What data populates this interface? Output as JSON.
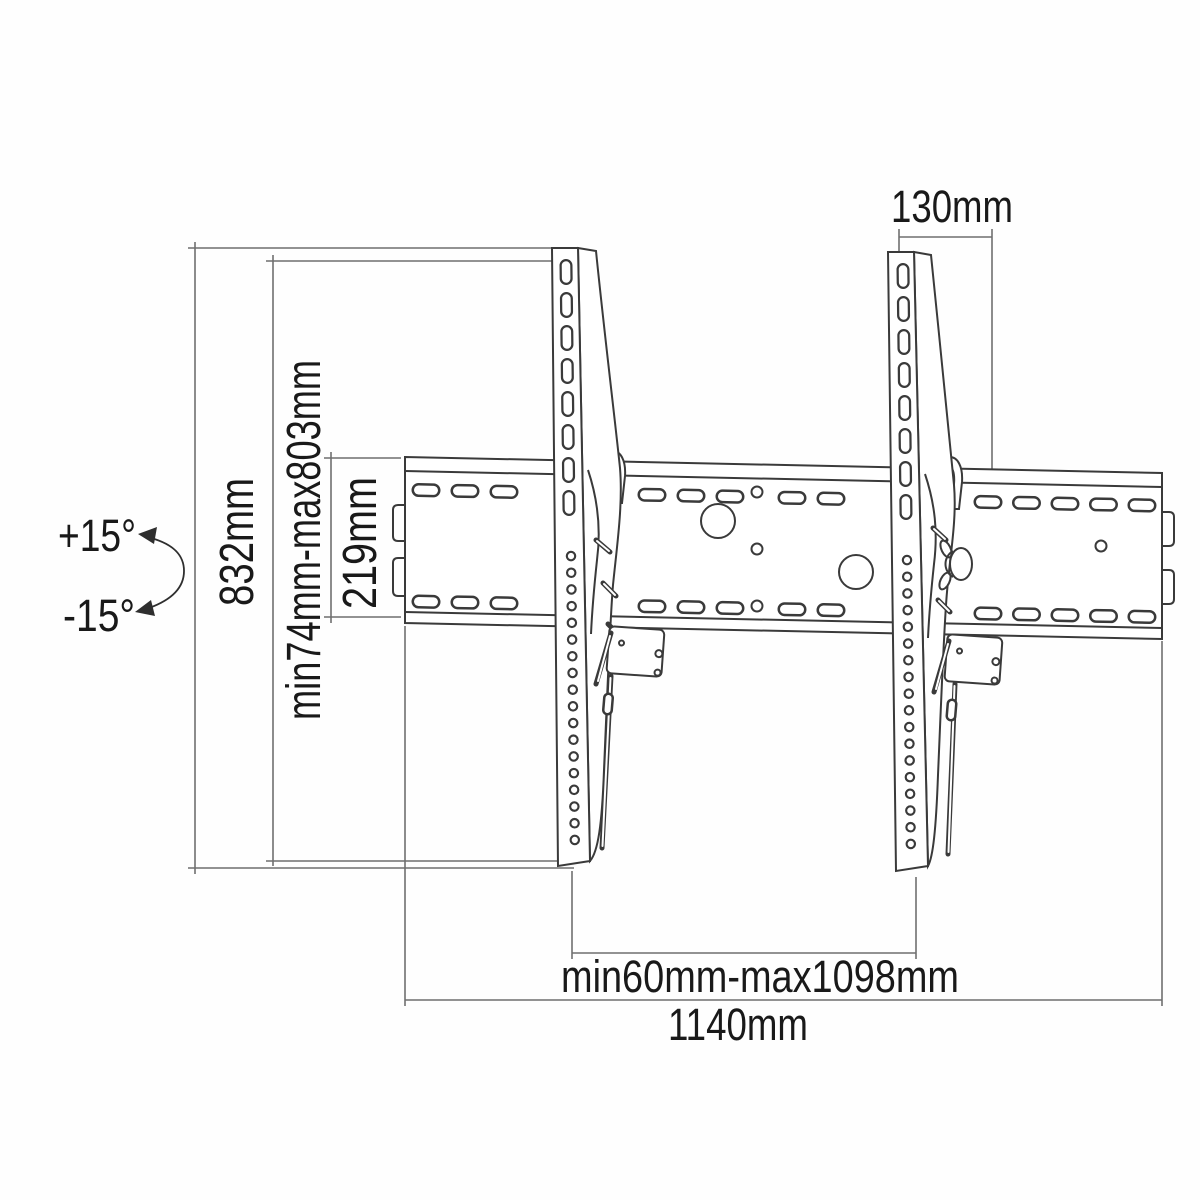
{
  "diagram": {
    "type": "technical-drawing",
    "subject": "Tilting TV wall-mount bracket dimensional diagram",
    "labels": {
      "bracket_top_offset": "130mm",
      "overall_height": "832mm",
      "mount_height_range": "min74mm-max803mm",
      "rail_height": "219mm",
      "arm_spacing_range": "min60mm-max1098mm",
      "overall_width": "1140mm",
      "tilt_up": "+15°",
      "tilt_down": "-15°"
    },
    "colors": {
      "background": "#fefefe",
      "drawing_line": "#3a3a3a",
      "dimension_line": "#6f6f6f",
      "text": "#191919"
    }
  }
}
